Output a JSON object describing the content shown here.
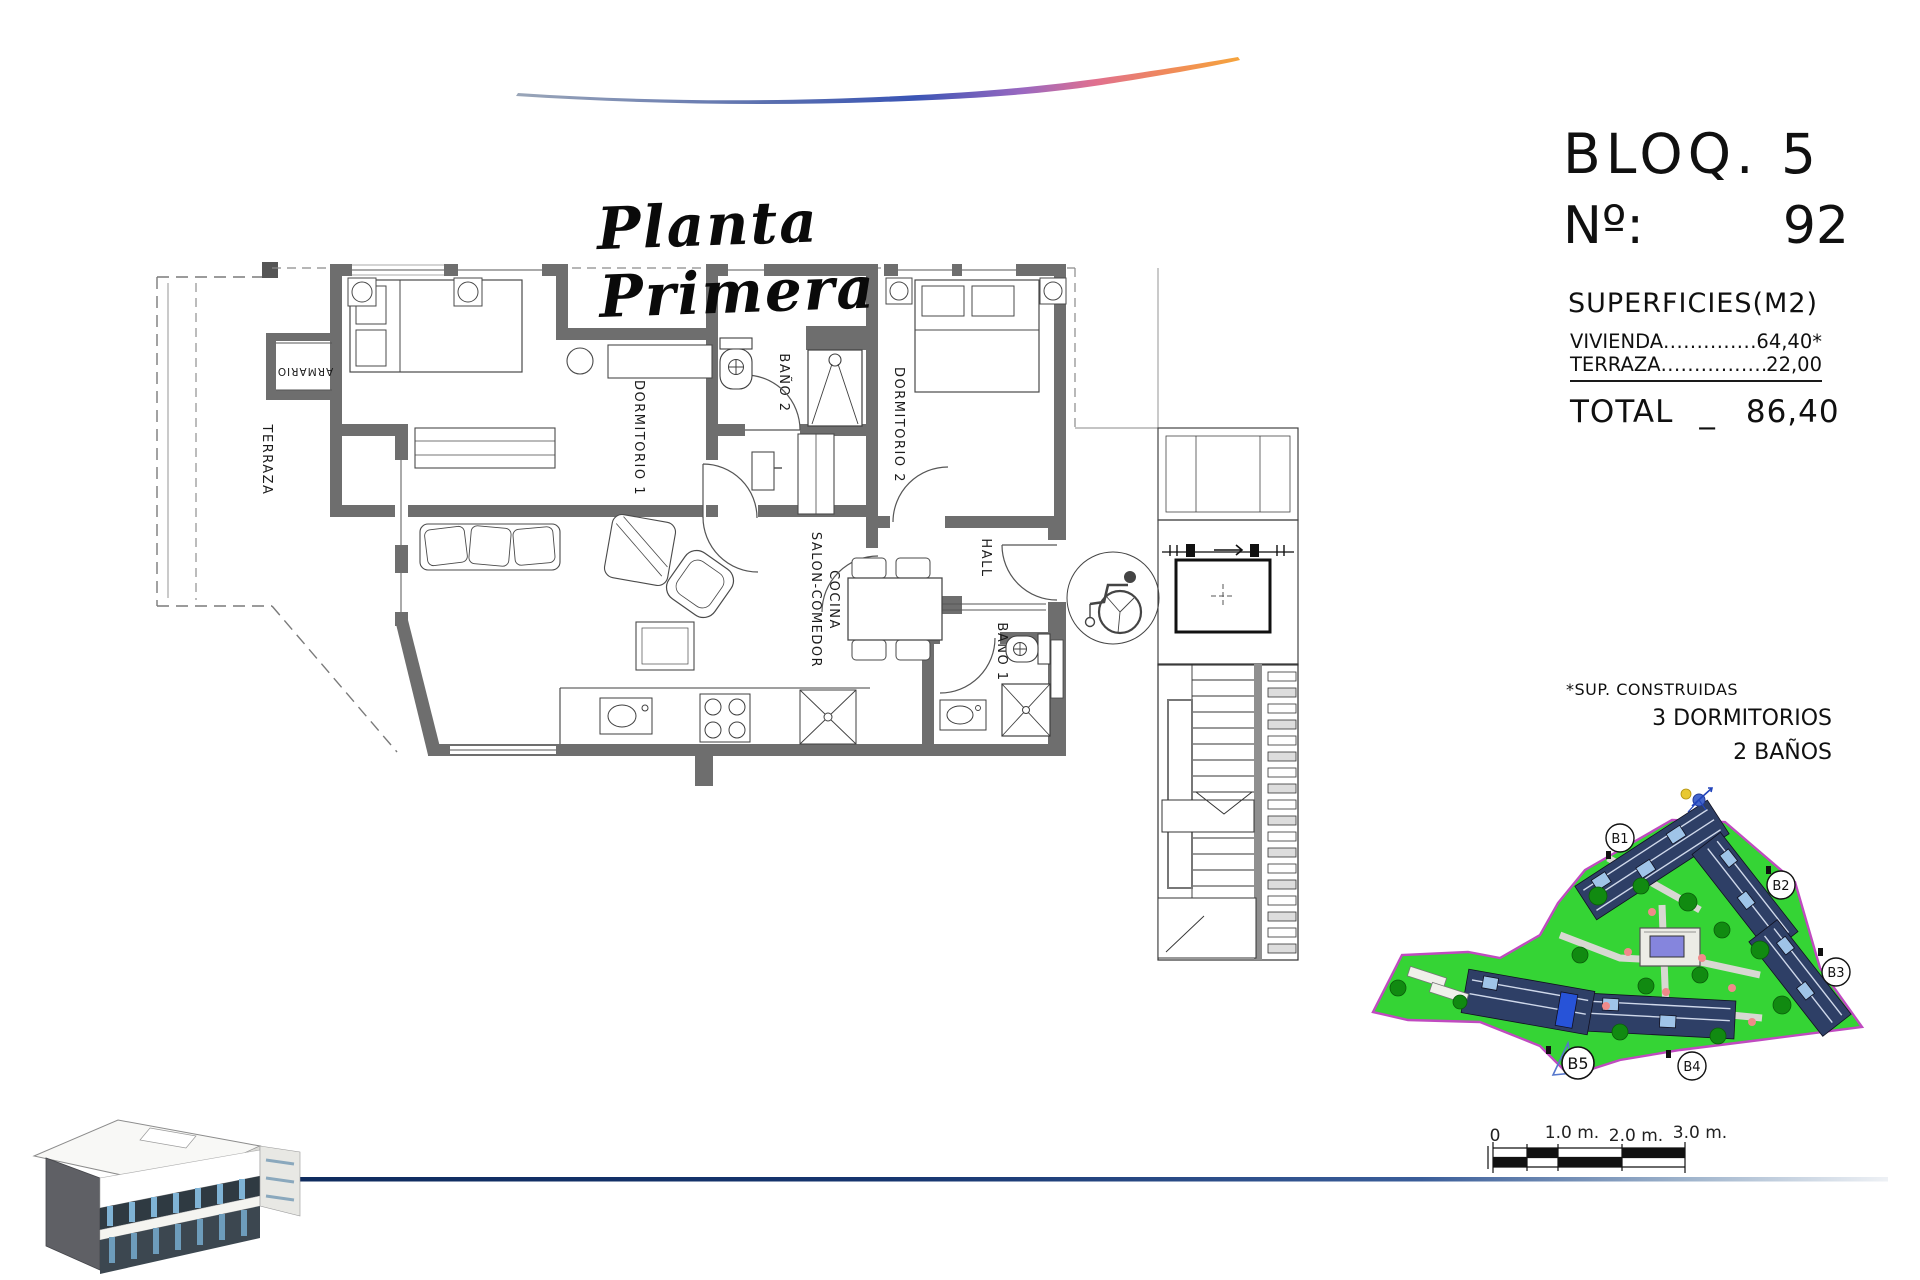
{
  "title": "Planta Primera",
  "header": {
    "block": "BLOQ. 5",
    "number_label": "Nº:",
    "number": "92"
  },
  "surfaces": {
    "title": "SUPERFICIES(M2)",
    "rows": [
      {
        "label": "VIVIENDA",
        "dots": "....................",
        "value": "64,40*"
      },
      {
        "label": "TERRAZA",
        "dots": "....................",
        "value": "22,00"
      }
    ],
    "total_label": "TOTAL",
    "total_separator": "_",
    "total_value": "86,40"
  },
  "notes": {
    "asterisk": "*SUP. CONSTRUIDAS",
    "bedrooms": "3 DORMITORIOS",
    "bathrooms": "2 BAÑOS"
  },
  "floorplan": {
    "labels": {
      "terraza": "TERRAZA",
      "armario": "ARMARIO",
      "dormitorio1": "DORMITORIO 1",
      "bano2": "BAÑO 2",
      "dormitorio2": "DORMITORIO 2",
      "hall": "HALL",
      "salon1": "SALON-COMEDOR",
      "salon2": "COCINA",
      "bano1": "BAÑO 1"
    }
  },
  "siteplan": {
    "blocks": [
      "B1",
      "B2",
      "B3",
      "B4",
      "B5"
    ]
  },
  "scalebar": {
    "labels": [
      "0",
      "1.0 m.",
      "2.0 m.",
      "3.0 m."
    ]
  },
  "colors": {
    "wall_gray": "#6e6e6e",
    "footer_blue": "#16356f",
    "site_green": "#35d435",
    "site_border": "#c04ac0",
    "block_highlight": "#2753d8"
  }
}
